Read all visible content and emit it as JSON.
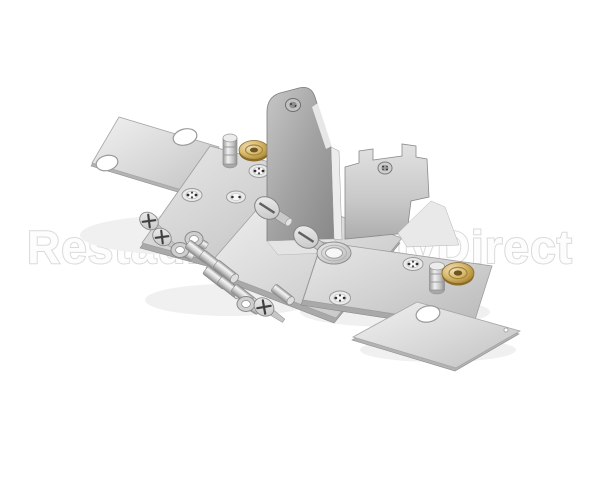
{
  "meta": {
    "type": "product-photo",
    "width": 600,
    "height": 480
  },
  "background": "#ffffff",
  "watermark": {
    "text": "RestaurantSupplyDirect",
    "fill": "#fdfdfd",
    "outline": "#d7d7d7",
    "opacity": 0.9
  },
  "palette": {
    "metal_light": "#efefef",
    "metal_mid": "#cfcfcf",
    "metal_shade": "#a8a8a8",
    "metal_edge": "#7f7f7f",
    "brass": "#c7a14f",
    "brass_light": "#ecd9a0",
    "brass_dark": "#8a6c28"
  },
  "parts": [
    {
      "name": "thin-cover-plate-top-left",
      "count": 1
    },
    {
      "name": "mounting-plate-with-stud-and-brass-bushing-left",
      "count": 1
    },
    {
      "name": "base-plate-center",
      "count": 1
    },
    {
      "name": "upright-bracket-left-wall",
      "count": 1
    },
    {
      "name": "upright-bracket-right-wall",
      "count": 1
    },
    {
      "name": "long-mounting-plate-with-stud-and-brass-bushing-right",
      "count": 1
    },
    {
      "name": "thin-cover-plate-bottom-right",
      "count": 1
    },
    {
      "name": "brass-bushing-washer",
      "count": 2
    },
    {
      "name": "mounting-stud-pin",
      "count": 2
    },
    {
      "name": "slotted-shoulder-screw",
      "count": 2
    },
    {
      "name": "flat-ring-washer",
      "count": 1
    },
    {
      "name": "phillips-flat-head-screw",
      "count": 3
    },
    {
      "name": "eyelet-washer",
      "count": 3
    },
    {
      "name": "cylindrical-spacer",
      "count": 7
    }
  ]
}
